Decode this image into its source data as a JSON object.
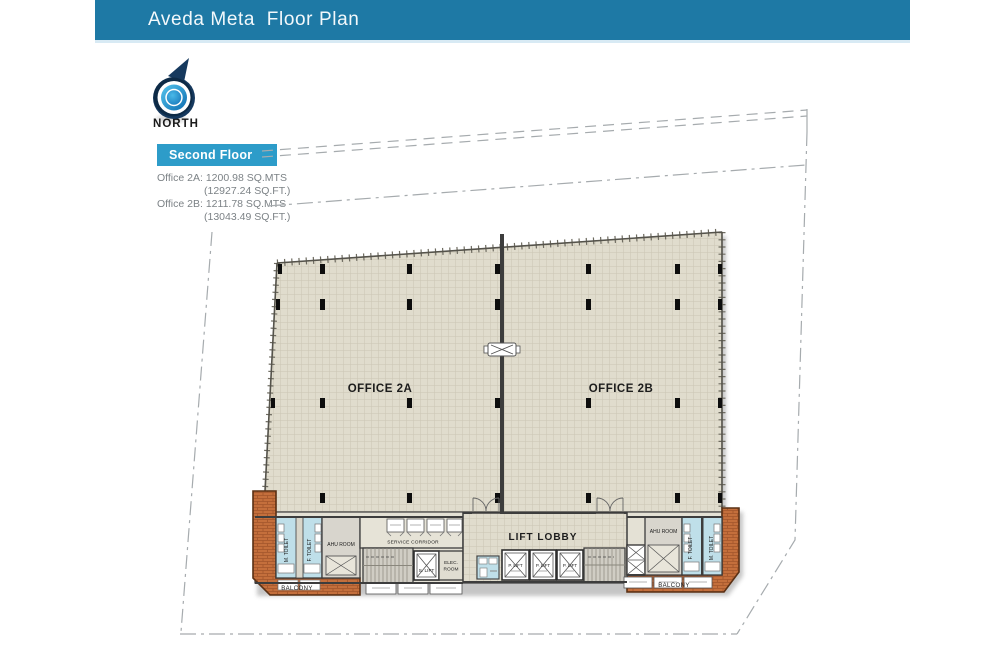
{
  "header": {
    "title": "Aveda Meta  Floor Plan"
  },
  "compass": {
    "label": "NORTH"
  },
  "floor_badge": {
    "label": "Second Floor"
  },
  "area_summary": {
    "office_2a_name": "Office 2A:",
    "office_2a_sqmts": "1200.98 SQ.MTS",
    "office_2a_sqft": "(12927.24 SQ.FT.)",
    "office_2b_name": "Office 2B:",
    "office_2b_sqmts": "1211.78 SQ.MTS",
    "office_2b_sqft": "(13043.49 SQ.FT.)"
  },
  "plan": {
    "office_2a": "OFFICE 2A",
    "office_2b": "OFFICE 2B",
    "lift_lobby": "LIFT LOBBY",
    "service_corridor": "SERVICE CORRIDOR",
    "ahu_room": "AHU ROOM",
    "elec_line1": "ELEC.",
    "elec_line2": "ROOM",
    "s_lift": "S. LIFT",
    "p_lift": "P. LIFT",
    "m_toilet": "M. TOILET",
    "f_toilet": "F. TOILET",
    "balcony": "BALCONY"
  },
  "colors": {
    "header_bar": "#1E79A5",
    "floor_badge": "#2D9CC9",
    "slab_fill": "#E0DCCD",
    "grid_line": "#CAC5B4",
    "balcony_brick": "#C46F3C",
    "toilet_blue": "#BFDFE9",
    "wall": "#3D3D3D",
    "compass_blue": "#29ABE2"
  }
}
